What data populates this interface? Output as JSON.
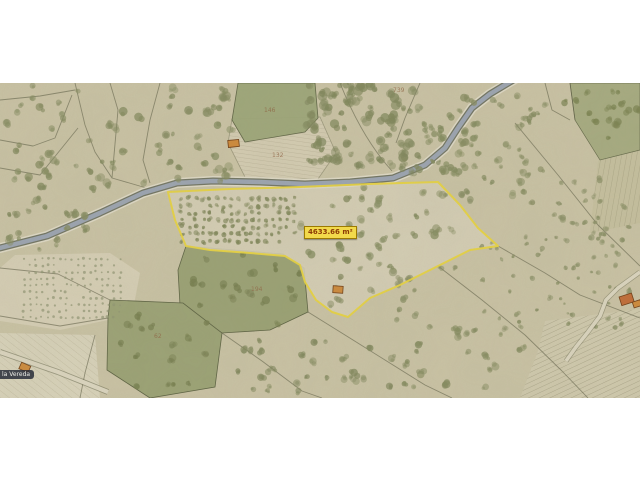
{
  "map": {
    "selected_parcel": {
      "area_label": "4633.66 m²"
    },
    "street_label": "la Vereda",
    "parcel_numbers": [
      "739",
      "146",
      "132",
      "194",
      "62"
    ],
    "colors": {
      "land_base": "#c9c2a4",
      "land_light": "#d6ceb5",
      "field_green": "#99a073",
      "tree_olive": "#848a5f",
      "boundary_line": "#5c5c44",
      "river_water": "#9aa3b1",
      "river_bank": "#ded9c6",
      "selection_yellow": "#e8d33e",
      "building_fill": "#cd8838",
      "building_outline": "#6f3b12",
      "area_label_bg": "#f2d94b",
      "area_label_text": "#8c3c05",
      "street_badge_bg": "#282d3a",
      "street_badge_text": "#eeeee8"
    }
  }
}
